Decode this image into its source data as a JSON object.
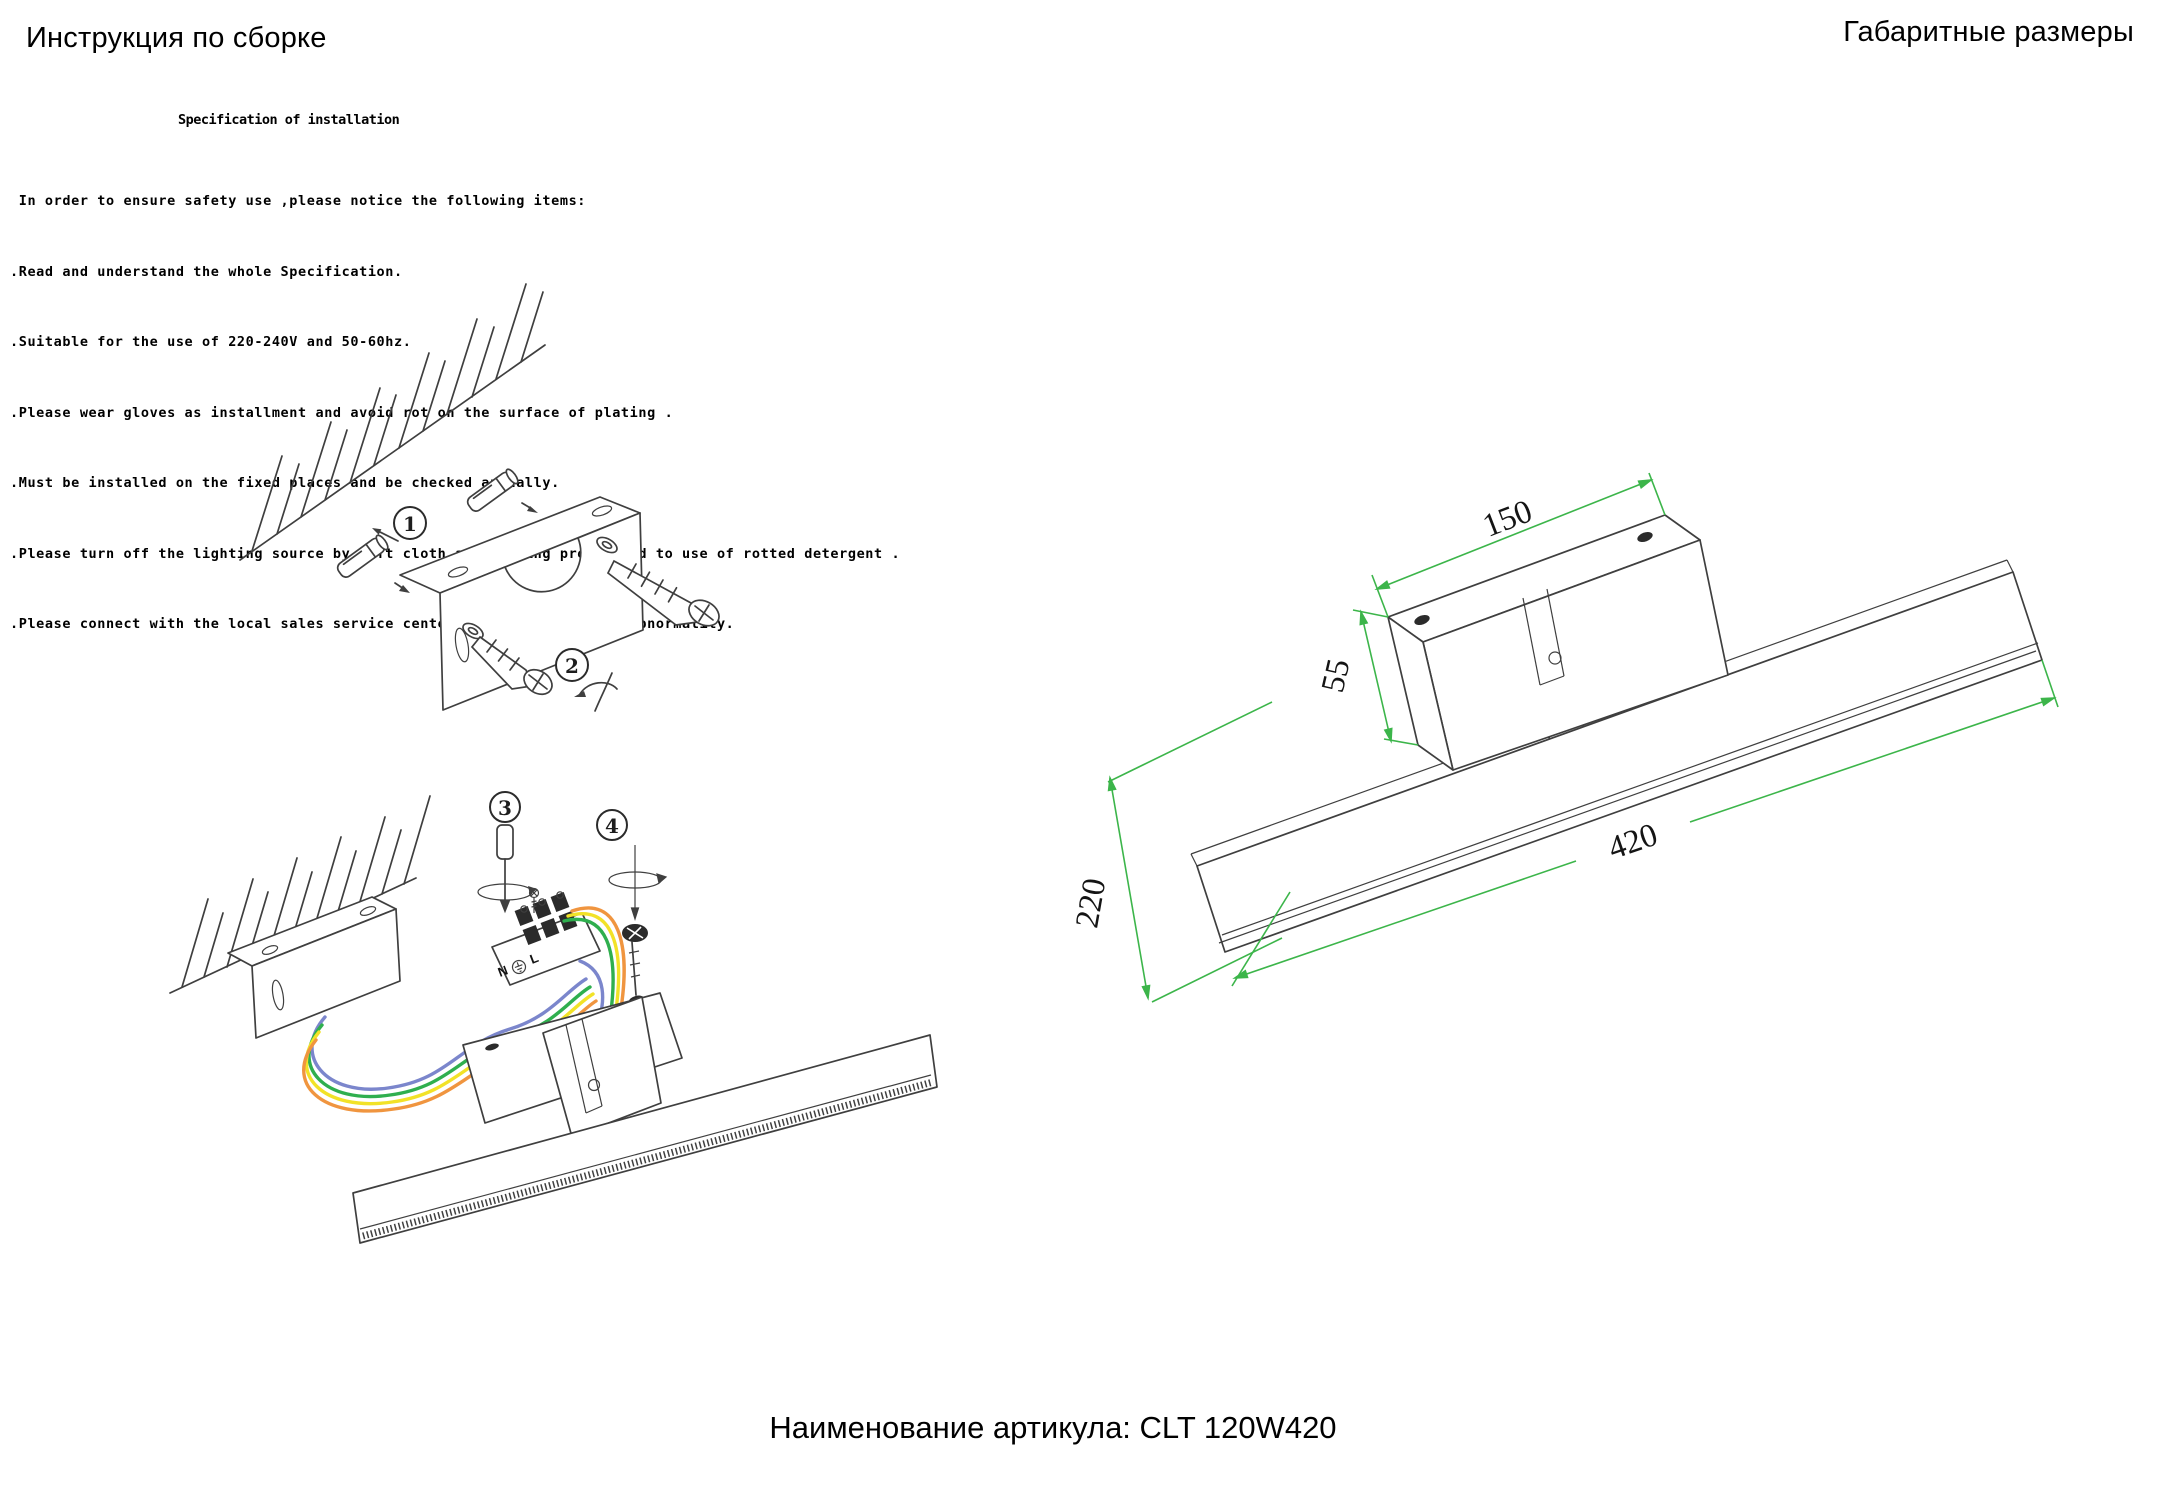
{
  "header": {
    "title_left": "Инструкция по сборке",
    "title_right": "Габаритные размеры"
  },
  "spec": {
    "heading": "Specification of installation",
    "lines": [
      " In order to ensure safety use ,please notice the following items:",
      ".Read and understand the whole Specification.",
      ".Suitable for the use of 220-240V and 50-60hz.",
      ".Please wear gloves as installment and avoid rot on the surface of plating .",
      ".Must be installed on the fixed places and be checked annually.",
      ".Please turn off the lighting source by soft cloth as cleaning prohibited to use of rotted detergent .",
      ".Please connect with the local sales service center when there are any abnormality."
    ]
  },
  "assembly_steps": {
    "step1": "1",
    "step2": "2",
    "step3": "3",
    "step4": "4"
  },
  "terminal": {
    "n": "N",
    "l": "L"
  },
  "dimensions": {
    "plate_width_mm": "150",
    "plate_height_mm": "55",
    "bar_length_mm": "420",
    "depth_mm": "220"
  },
  "footer": {
    "article": "Наименование артикула: CLT 120W420"
  },
  "colors": {
    "dimension": "#3CB54A",
    "wire_blue": "#7B86CC",
    "wire_green": "#2FAF4E",
    "wire_yellow": "#F2E227",
    "wire_orange": "#F0953F",
    "line": "#3F3F3F"
  }
}
